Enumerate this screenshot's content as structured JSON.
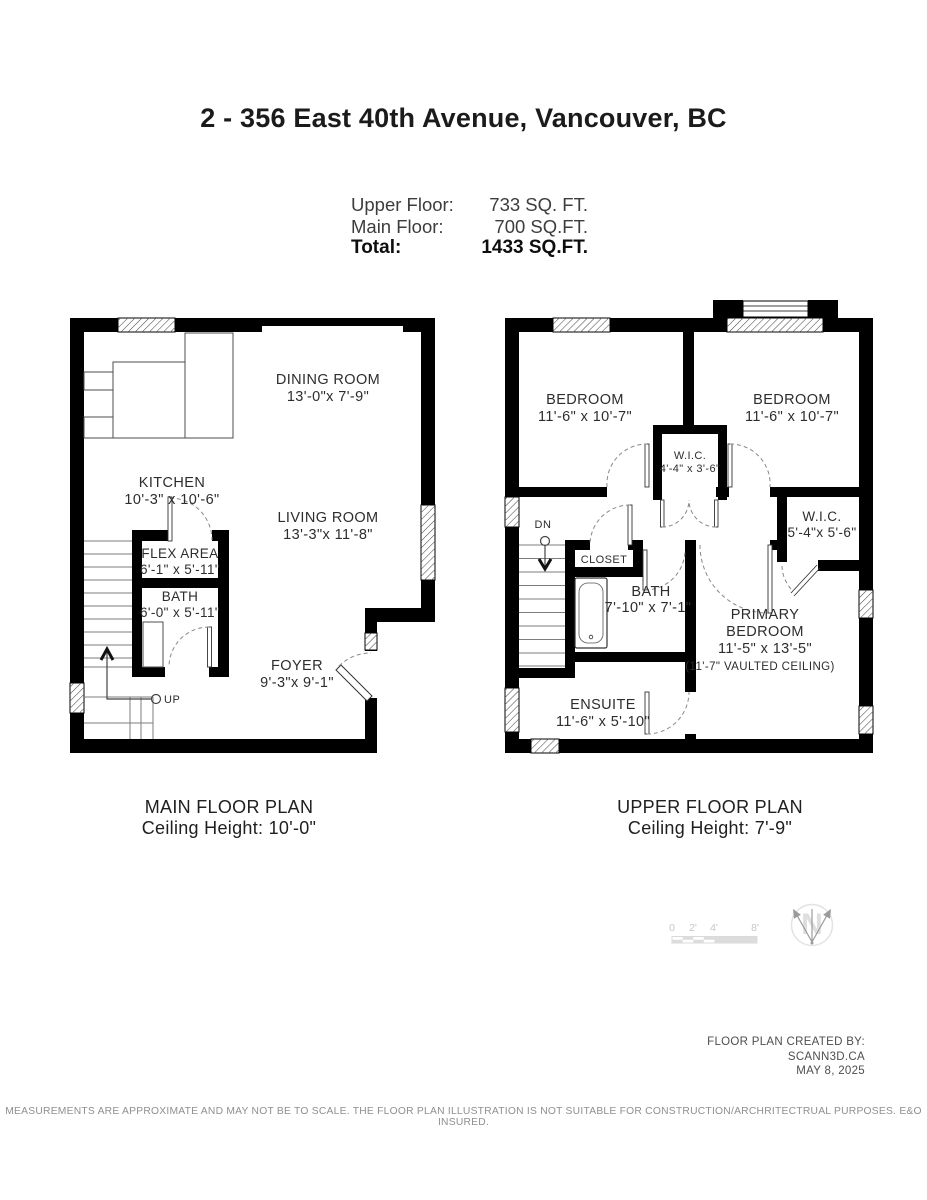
{
  "title": "2 - 356 East 40th Avenue, Vancouver, BC",
  "area_summary": {
    "rows": [
      {
        "label": "Upper Floor:",
        "value": "733 SQ. FT."
      },
      {
        "label": "Main Floor:",
        "value": "700 SQ.FT."
      },
      {
        "label": "Total:",
        "value": "1433 SQ.FT."
      }
    ]
  },
  "main_floor": {
    "caption": {
      "line1": "MAIN FLOOR PLAN",
      "line2": "Ceiling Height: 10'-0\""
    },
    "rooms": [
      {
        "name": "DINING ROOM",
        "dims": "13'-0\"x 7'-9\""
      },
      {
        "name": "KITCHEN",
        "dims": "10'-3\" x 10'-6\""
      },
      {
        "name": "LIVING ROOM",
        "dims": "13'-3\"x 11'-8\""
      },
      {
        "name": "FLEX AREA",
        "dims": "6'-1\" x 5'-11\""
      },
      {
        "name": "BATH",
        "dims": "6'-0\" x 5'-11\""
      },
      {
        "name": "FOYER",
        "dims": "9'-3\"x 9'-1\""
      }
    ],
    "stair_label": "UP"
  },
  "upper_floor": {
    "caption": {
      "line1": "UPPER FLOOR PLAN",
      "line2": "Ceiling Height: 7'-9\""
    },
    "rooms": [
      {
        "name": "BEDROOM",
        "dims": "11'-6\" x 10'-7\""
      },
      {
        "name": "BEDROOM",
        "dims": "11'-6\" x 10'-7\""
      },
      {
        "name": "W.I.C.",
        "dims": "4'-4\" x 3'-6\""
      },
      {
        "name": "W.I.C.",
        "dims": "5'-4\"x 5'-6\""
      },
      {
        "name": "CLOSET",
        "dims": ""
      },
      {
        "name": "BATH",
        "dims": "7'-10\" x 7'-1\""
      },
      {
        "name_lines": [
          "PRIMARY",
          "BEDROOM"
        ],
        "dims": "11'-5\" x 13'-5\"",
        "note": "(11'-7\" VAULTED CEILING)"
      },
      {
        "name": "ENSUITE",
        "dims": "11'-6\" x 5'-10\""
      }
    ],
    "stair_label": "DN"
  },
  "scale_bar": {
    "ticks": [
      "0",
      "2'",
      "4'",
      "8'"
    ]
  },
  "compass": {
    "label": "N"
  },
  "attribution": {
    "line1": "FLOOR PLAN CREATED BY:",
    "line2": "SCANN3D.CA",
    "line3": "MAY 8, 2025"
  },
  "disclaimer": "MEASUREMENTS ARE APPROXIMATE AND MAY NOT BE TO SCALE. THE FLOOR PLAN ILLUSTRATION IS NOT SUITABLE FOR CONSTRUCTION/ARCHRITECTRUAL PURPOSES. E&O INSURED.",
  "colors": {
    "wall": "#000000",
    "label": "#2d2d2d",
    "muted": "#9a9a9a",
    "scale": "#cccccc"
  }
}
